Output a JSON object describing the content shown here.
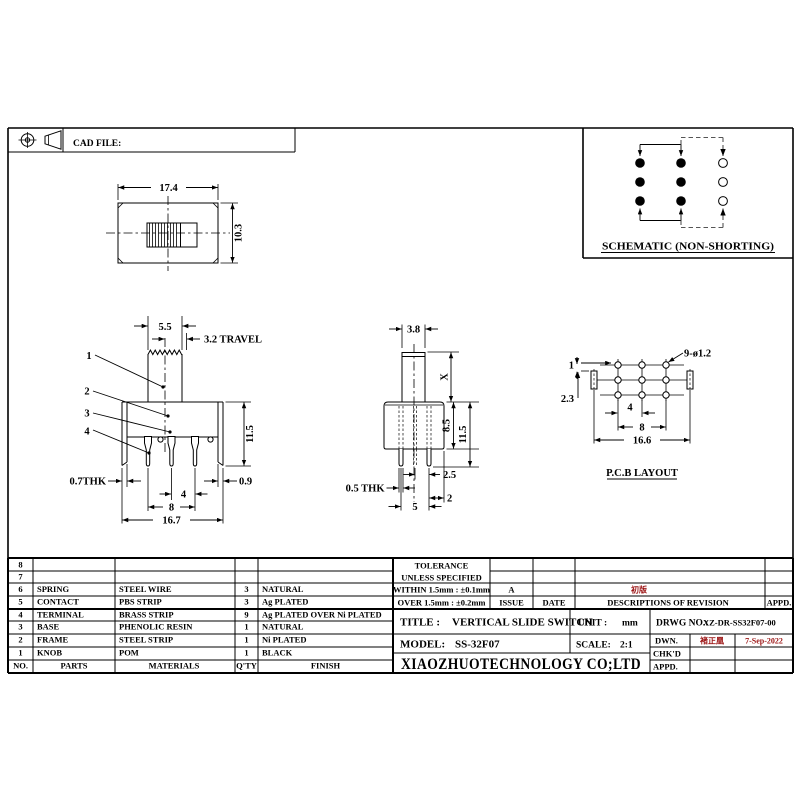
{
  "frame": {
    "cad_file_label": "CAD FILE:"
  },
  "schematic": {
    "caption": "SCHEMATIC (NON-SHORTING)"
  },
  "top_view": {
    "dim_width": "17.4",
    "dim_height": "10.3"
  },
  "front_view": {
    "dim_knob": "5.5",
    "dim_travel": "3.2 TRAVEL",
    "ref1": "1",
    "ref2": "2",
    "ref3": "3",
    "ref4": "4",
    "dim_height": "11.5",
    "dim_thk": "0.7THK",
    "dim_leg": "0.9",
    "dim_pitch": "4",
    "dim_span": "8",
    "dim_width": "16.7"
  },
  "side_view": {
    "dim_knob": "3.8",
    "dim_x": "X",
    "dim_body": "8.5",
    "dim_height": "11.5",
    "dim_offset": "2.5",
    "dim_thk": "0.5 THK",
    "dim_edge": "2",
    "dim_span": "5"
  },
  "pcb": {
    "caption": "P.C.B LAYOUT",
    "callout": "9-ø1.2",
    "dim_1": "1",
    "dim_2_3": "2.3",
    "dim_4": "4",
    "dim_8": "8",
    "dim_16_6": "16.6"
  },
  "parts_table": {
    "col_no": "NO.",
    "col_parts": "PARTS",
    "col_materials": "MATERIALS",
    "col_qty": "Q'TY",
    "col_finish": "FINISH",
    "rows": [
      {
        "no": "8",
        "part": "",
        "material": "",
        "qty": "",
        "finish": ""
      },
      {
        "no": "7",
        "part": "",
        "material": "",
        "qty": "",
        "finish": ""
      },
      {
        "no": "6",
        "part": "SPRING",
        "material": "STEEL WIRE",
        "qty": "3",
        "finish": "NATURAL"
      },
      {
        "no": "5",
        "part": "CONTACT",
        "material": "PBS STRIP",
        "qty": "3",
        "finish": "Ag PLATED"
      },
      {
        "no": "4",
        "part": "TERMINAL",
        "material": "BRASS STRIP",
        "qty": "9",
        "finish": "Ag PLATED OVER Ni PLATED"
      },
      {
        "no": "3",
        "part": "BASE",
        "material": "PHENOLIC RESIN",
        "qty": "1",
        "finish": "NATURAL"
      },
      {
        "no": "2",
        "part": "FRAME",
        "material": "STEEL STRIP",
        "qty": "1",
        "finish": "Ni PLATED"
      },
      {
        "no": "1",
        "part": "KNOB",
        "material": "POM",
        "qty": "1",
        "finish": "BLACK"
      }
    ]
  },
  "tolerance": {
    "line1": "TOLERANCE",
    "line2": "UNLESS SPECIFIED",
    "within": "WITHIN 1.5mm : ±0.1mm",
    "over": "OVER 1.5mm : ±0.2mm",
    "issue_value": "A",
    "issue_label": "ISSUE",
    "date_label": "DATE"
  },
  "revision": {
    "descriptions_label": "DESCRIPTIONS OF REVISION",
    "appd_label": "APPD.",
    "entry_a_desc": "初版"
  },
  "title_block": {
    "title_label": "TITLE :",
    "title": "VERTICAL SLIDE SWITCH",
    "model_label": "MODEL:",
    "model": "SS-32F07",
    "unit_label": "UNIT :",
    "unit": "mm",
    "scale_label": "SCALE:",
    "scale": "2:1",
    "drwg_label": "DRWG NO.:",
    "drwg_no": "XZ-DR-SS32F07-00",
    "company": "XIAOZHUOTECHNOLOGY CO;LTD",
    "dwn_label": "DWN.",
    "dwn_sign": "褚正凰",
    "dwn_date": "7-Sep-2022",
    "chkd_label": "CHK'D",
    "appd_label": "APPD."
  }
}
